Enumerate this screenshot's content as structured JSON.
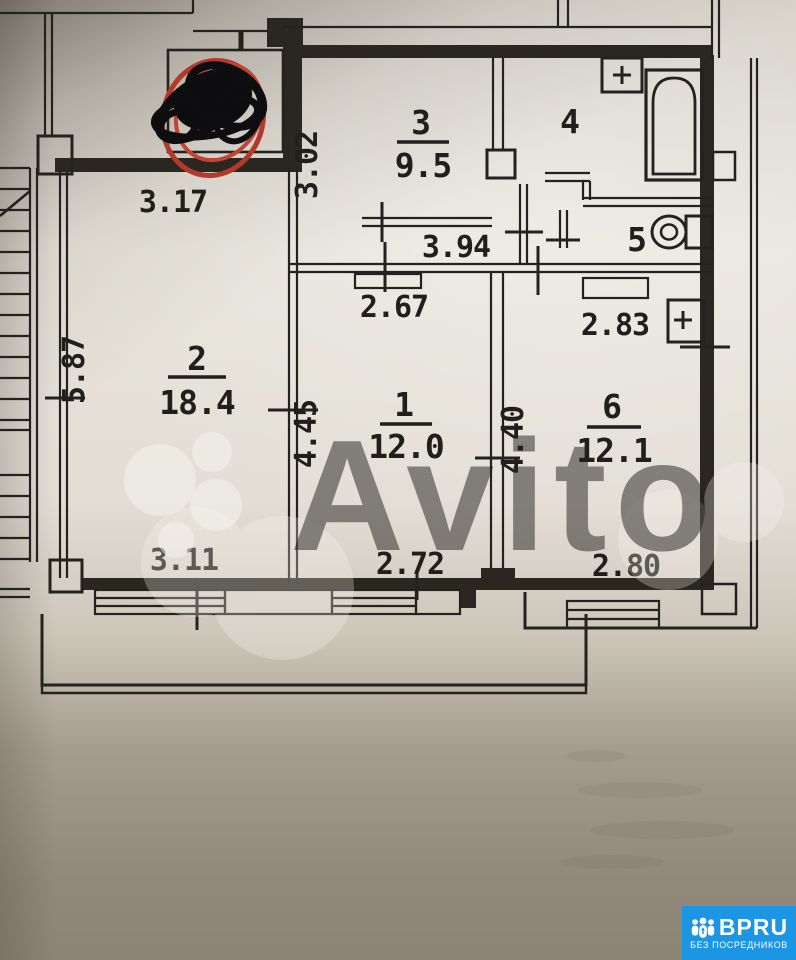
{
  "photo": {
    "watermark": "Avito",
    "badge": {
      "brand": "BPRU",
      "tagline": "БЕЗ ПОСРЕДНИКОВ",
      "color": "#1c95e4"
    }
  },
  "plan": {
    "rooms": {
      "r1": {
        "num": "1",
        "area": "12.0",
        "top": "2.67",
        "left": "4.45",
        "bottom": "2.72"
      },
      "r2": {
        "num": "2",
        "area": "18.4",
        "top": "3.17",
        "left": "5.87",
        "bottom": "3.11"
      },
      "r3": {
        "num": "3",
        "area": "9.5",
        "left": "3.02"
      },
      "r4": {
        "num": "4"
      },
      "r5": {
        "num": "5"
      },
      "r6": {
        "num": "6",
        "area": "12.1",
        "top": "2.83",
        "left": "4.40",
        "bottom": "2.80"
      }
    },
    "corridor": {
      "width": "3.94"
    }
  }
}
